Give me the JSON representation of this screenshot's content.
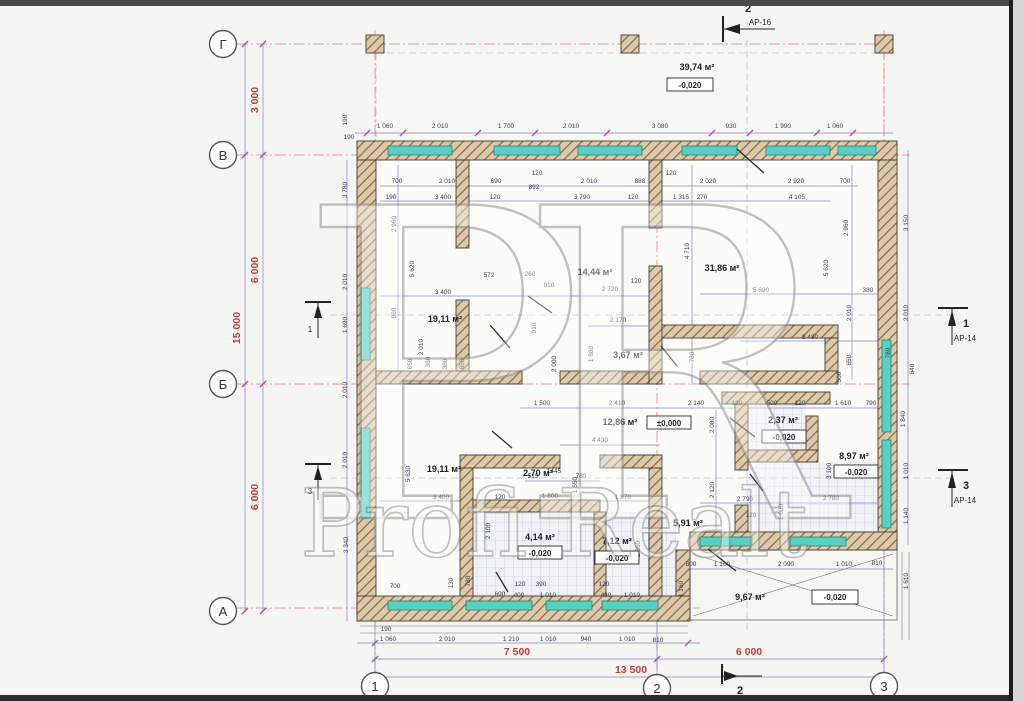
{
  "axes": {
    "row_labels": [
      "Г",
      "В",
      "Б",
      "А"
    ],
    "col_labels": [
      "1",
      "2",
      "3"
    ],
    "left_dims": [
      "3 000",
      "6 000",
      "6 000"
    ],
    "left_total": "15 000",
    "bottom_dims": [
      "7 500",
      "6 000"
    ],
    "bottom_total": "13 500"
  },
  "markers": {
    "top": {
      "num": "2",
      "sheet": "АР-16"
    },
    "right_upper": {
      "num": "1",
      "sheet": "АР-14"
    },
    "right_lower": {
      "num": "3",
      "sheet": "АР-14"
    },
    "left_upper": {
      "num": "1"
    },
    "left_lower": {
      "num": "3"
    },
    "bottom": {
      "num": "2"
    }
  },
  "rooms": [
    {
      "id": "porch",
      "area": "39,74 м²",
      "elevation": "-0,020"
    },
    {
      "id": "room-top-left",
      "area": "19,11 м²"
    },
    {
      "id": "room-top-mid",
      "area": "14,44 м²"
    },
    {
      "id": "room-top-right",
      "area": "31,86 м²"
    },
    {
      "id": "wc-top",
      "area": "3,67 м²"
    },
    {
      "id": "hall",
      "area": "12,86 м²",
      "elevation": "±0,000"
    },
    {
      "id": "lobby",
      "area": "2,37 м²",
      "elevation": "-0,020"
    },
    {
      "id": "bath-right",
      "area": "8,97 м²",
      "elevation": "-0,020"
    },
    {
      "id": "room-bottom-left",
      "area": "19,11 м²"
    },
    {
      "id": "closet",
      "area": "2,70 м²"
    },
    {
      "id": "corridor",
      "area": "5,91 м²"
    },
    {
      "id": "wc-bottom",
      "area": "4,14 м²",
      "elevation": "-0,020"
    },
    {
      "id": "bath-bottom",
      "area": "7,12 м²",
      "elevation": "-0,020"
    },
    {
      "id": "terrace",
      "area": "9,67 м²",
      "elevation": "-0,020"
    }
  ],
  "watermark": {
    "monogram": "PR",
    "text": "Profi Realt"
  },
  "colors": {
    "wall_hatch": "#8a6b4a",
    "wall_fill": "#dbc9aa",
    "window": "#5ad0c3",
    "axis_red": "#c23b3b",
    "dim_line": "#8486c0",
    "dim_text": "#3c3c52",
    "tick": "#b545b5",
    "watermark": "#919191"
  },
  "dim_labels": [
    {
      "x": 349,
      "y": 139,
      "t": "190"
    },
    {
      "x": 385,
      "y": 128,
      "t": "1 060"
    },
    {
      "x": 440,
      "y": 128,
      "t": "2 010"
    },
    {
      "x": 506,
      "y": 128,
      "t": "1 700"
    },
    {
      "x": 571,
      "y": 128,
      "t": "2 010"
    },
    {
      "x": 660,
      "y": 128,
      "t": "3 080"
    },
    {
      "x": 731,
      "y": 128,
      "t": "930"
    },
    {
      "x": 783,
      "y": 128,
      "t": "1 990"
    },
    {
      "x": 835,
      "y": 128,
      "t": "1 060"
    },
    {
      "x": 397,
      "y": 183,
      "t": "700"
    },
    {
      "x": 447,
      "y": 183,
      "t": "2 010"
    },
    {
      "x": 496,
      "y": 183,
      "t": "690"
    },
    {
      "x": 537,
      "y": 175,
      "t": "120"
    },
    {
      "x": 534,
      "y": 189,
      "t": "892"
    },
    {
      "x": 589,
      "y": 183,
      "t": "2 010"
    },
    {
      "x": 640,
      "y": 183,
      "t": "888"
    },
    {
      "x": 671,
      "y": 175,
      "t": "120"
    },
    {
      "x": 708,
      "y": 183,
      "t": "2 020"
    },
    {
      "x": 796,
      "y": 183,
      "t": "2 920"
    },
    {
      "x": 845,
      "y": 183,
      "t": "700"
    },
    {
      "x": 391,
      "y": 199,
      "t": "190"
    },
    {
      "x": 443,
      "y": 199,
      "t": "3 400"
    },
    {
      "x": 495,
      "y": 199,
      "t": "120"
    },
    {
      "x": 582,
      "y": 199,
      "t": "3 790"
    },
    {
      "x": 633,
      "y": 199,
      "t": "120"
    },
    {
      "x": 681,
      "y": 199,
      "t": "1 315"
    },
    {
      "x": 702,
      "y": 199,
      "t": "270"
    },
    {
      "x": 797,
      "y": 199,
      "t": "4 105"
    },
    {
      "x": 347,
      "y": 120,
      "t": "190",
      "r": 1
    },
    {
      "x": 347,
      "y": 190,
      "t": "3 780",
      "r": 1
    },
    {
      "x": 347,
      "y": 282,
      "t": "2 010",
      "r": 1
    },
    {
      "x": 347,
      "y": 325,
      "t": "1 690",
      "r": 1
    },
    {
      "x": 347,
      "y": 390,
      "t": "2 010",
      "r": 1
    },
    {
      "x": 347,
      "y": 460,
      "t": "2 010",
      "r": 1
    },
    {
      "x": 348,
      "y": 545,
      "t": "3 340",
      "r": 1
    },
    {
      "x": 396,
      "y": 224,
      "t": "2 960",
      "r": 1
    },
    {
      "x": 414,
      "y": 269,
      "t": "5 620",
      "r": 1
    },
    {
      "x": 396,
      "y": 313,
      "t": "960",
      "r": 1
    },
    {
      "x": 423,
      "y": 347,
      "t": "2 010",
      "r": 1
    },
    {
      "x": 412,
      "y": 364,
      "t": "650",
      "r": 1
    },
    {
      "x": 430,
      "y": 362,
      "t": "360",
      "r": 1
    },
    {
      "x": 447,
      "y": 364,
      "t": "380",
      "r": 1
    },
    {
      "x": 464,
      "y": 364,
      "t": "650",
      "r": 1
    },
    {
      "x": 536,
      "y": 328,
      "t": "910",
      "r": 1
    },
    {
      "x": 489,
      "y": 277,
      "t": "572"
    },
    {
      "x": 530,
      "y": 276,
      "t": "260"
    },
    {
      "x": 549,
      "y": 287,
      "t": "910"
    },
    {
      "x": 443,
      "y": 294,
      "t": "3 400"
    },
    {
      "x": 610,
      "y": 291,
      "t": "2 720"
    },
    {
      "x": 636,
      "y": 283,
      "t": "120"
    },
    {
      "x": 761,
      "y": 292,
      "t": "5 690"
    },
    {
      "x": 868,
      "y": 292,
      "t": "380"
    },
    {
      "x": 810,
      "y": 339,
      "t": "3 430"
    },
    {
      "x": 618,
      "y": 322,
      "t": "2 170"
    },
    {
      "x": 689,
      "y": 251,
      "t": "4 710",
      "r": 1
    },
    {
      "x": 828,
      "y": 268,
      "t": "5 620",
      "r": 1
    },
    {
      "x": 848,
      "y": 228,
      "t": "2 960",
      "r": 1
    },
    {
      "x": 851,
      "y": 313,
      "t": "2 010",
      "r": 1
    },
    {
      "x": 851,
      "y": 360,
      "t": "650",
      "r": 1
    },
    {
      "x": 694,
      "y": 357,
      "t": "780",
      "r": 1
    },
    {
      "x": 890,
      "y": 353,
      "t": "780",
      "r": 1
    },
    {
      "x": 841,
      "y": 377,
      "t": "500",
      "r": 1
    },
    {
      "x": 593,
      "y": 354,
      "t": "1 680",
      "r": 1
    },
    {
      "x": 556,
      "y": 364,
      "t": "2 000",
      "r": 1
    },
    {
      "x": 908,
      "y": 223,
      "t": "3 150",
      "r": 1
    },
    {
      "x": 908,
      "y": 313,
      "t": "2 010",
      "r": 1
    },
    {
      "x": 914,
      "y": 369,
      "t": "640",
      "r": 1
    },
    {
      "x": 905,
      "y": 419,
      "t": "1 840",
      "r": 1
    },
    {
      "x": 908,
      "y": 471,
      "t": "1 010",
      "r": 1
    },
    {
      "x": 908,
      "y": 516,
      "t": "1 140",
      "r": 1
    },
    {
      "x": 542,
      "y": 405,
      "t": "1 500"
    },
    {
      "x": 617,
      "y": 405,
      "t": "2 410"
    },
    {
      "x": 696,
      "y": 405,
      "t": "2 140"
    },
    {
      "x": 737,
      "y": 405,
      "t": "120"
    },
    {
      "x": 772,
      "y": 405,
      "t": "500"
    },
    {
      "x": 800,
      "y": 405,
      "t": "120"
    },
    {
      "x": 843,
      "y": 405,
      "t": "1 610"
    },
    {
      "x": 871,
      "y": 405,
      "t": "790"
    },
    {
      "x": 600,
      "y": 442,
      "t": "4 430"
    },
    {
      "x": 714,
      "y": 425,
      "t": "2 080",
      "r": 1
    },
    {
      "x": 714,
      "y": 490,
      "t": "2 120",
      "r": 1
    },
    {
      "x": 745,
      "y": 501,
      "t": "2 790"
    },
    {
      "x": 831,
      "y": 500,
      "t": "2 780"
    },
    {
      "x": 751,
      "y": 517,
      "t": "120"
    },
    {
      "x": 831,
      "y": 471,
      "t": "3 100",
      "r": 1
    },
    {
      "x": 783,
      "y": 512,
      "t": "1 080",
      "r": 1
    },
    {
      "x": 441,
      "y": 499,
      "t": "3 400"
    },
    {
      "x": 500,
      "y": 499,
      "t": "120"
    },
    {
      "x": 550,
      "y": 498,
      "t": "1 800"
    },
    {
      "x": 623,
      "y": 499,
      "t": "1 870"
    },
    {
      "x": 533,
      "y": 478,
      "t": "515"
    },
    {
      "x": 554,
      "y": 473,
      "t": "1445"
    },
    {
      "x": 581,
      "y": 478,
      "t": "780"
    },
    {
      "x": 410,
      "y": 474,
      "t": "5 630",
      "r": 1
    },
    {
      "x": 577,
      "y": 485,
      "t": "1 550",
      "r": 1
    },
    {
      "x": 490,
      "y": 531,
      "t": "2 100",
      "r": 1
    },
    {
      "x": 640,
      "y": 549,
      "t": "2 350",
      "r": 1
    },
    {
      "x": 453,
      "y": 583,
      "t": "130",
      "r": 1
    },
    {
      "x": 470,
      "y": 581,
      "t": "780",
      "r": 1
    },
    {
      "x": 395,
      "y": 588,
      "t": "700"
    },
    {
      "x": 500,
      "y": 596,
      "t": "690"
    },
    {
      "x": 520,
      "y": 586,
      "t": "120"
    },
    {
      "x": 541,
      "y": 586,
      "t": "390"
    },
    {
      "x": 519,
      "y": 597,
      "t": "400"
    },
    {
      "x": 548,
      "y": 597,
      "t": "1 010"
    },
    {
      "x": 604,
      "y": 586,
      "t": "120"
    },
    {
      "x": 606,
      "y": 597,
      "t": "430"
    },
    {
      "x": 632,
      "y": 597,
      "t": "1 010"
    },
    {
      "x": 691,
      "y": 566,
      "t": "800"
    },
    {
      "x": 722,
      "y": 566,
      "t": "1 100"
    },
    {
      "x": 786,
      "y": 566,
      "t": "2 090"
    },
    {
      "x": 844,
      "y": 566,
      "t": "1 010"
    },
    {
      "x": 877,
      "y": 565,
      "t": "810"
    },
    {
      "x": 683,
      "y": 589,
      "t": "1 160",
      "r": 1
    },
    {
      "x": 908,
      "y": 581,
      "t": "1 610",
      "r": 1
    },
    {
      "x": 386,
      "y": 631,
      "t": "190"
    },
    {
      "x": 388,
      "y": 641,
      "t": "1 060"
    },
    {
      "x": 447,
      "y": 641,
      "t": "2 010"
    },
    {
      "x": 511,
      "y": 641,
      "t": "1 210"
    },
    {
      "x": 548,
      "y": 641,
      "t": "1 010"
    },
    {
      "x": 586,
      "y": 641,
      "t": "940"
    },
    {
      "x": 627,
      "y": 641,
      "t": "1 010"
    },
    {
      "x": 658,
      "y": 642,
      "t": "810"
    }
  ]
}
